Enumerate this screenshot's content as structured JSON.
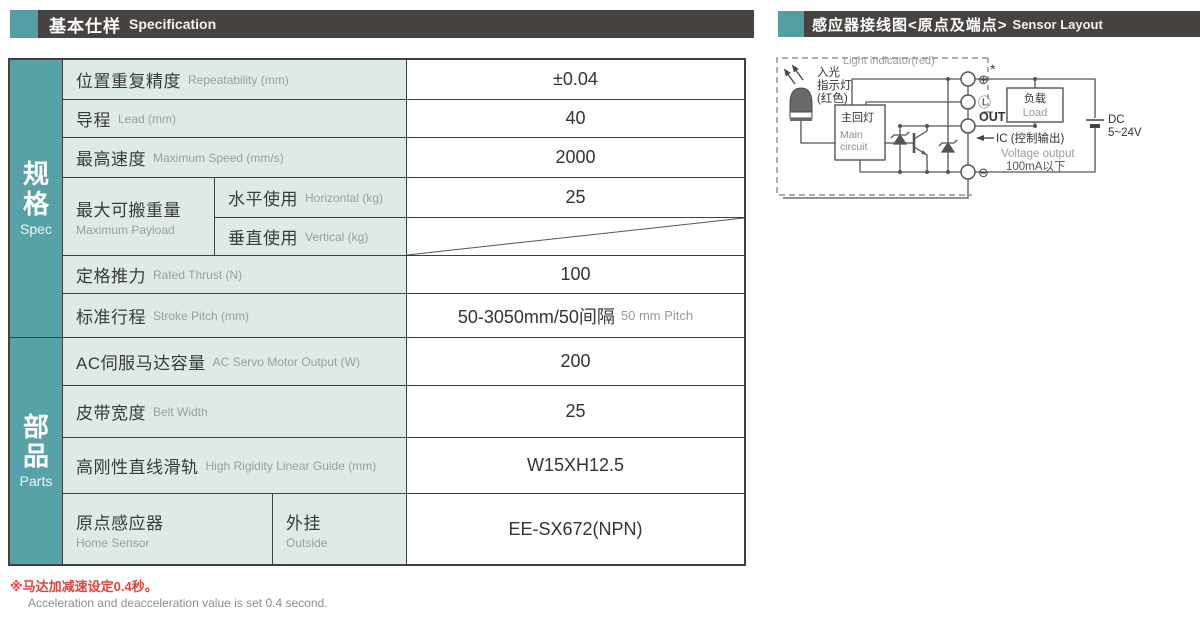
{
  "headers": {
    "left": {
      "zh": "基本仕样",
      "en": "Specification"
    },
    "right": {
      "zh": "感应器接线图<原点及端点>",
      "en": "Sensor Layout"
    }
  },
  "accent_color": "#539da3",
  "header_bar_color": "#474341",
  "table": {
    "sections": [
      {
        "zh": "规格",
        "en": "Spec"
      },
      {
        "zh": "部品",
        "en": "Parts"
      }
    ],
    "rows": {
      "repeatability": {
        "zh": "位置重复精度",
        "en": "Repeatability (mm)",
        "value": "±0.04"
      },
      "lead": {
        "zh": "导程",
        "en": "Lead (mm)",
        "value": "40"
      },
      "max_speed": {
        "zh": "最高速度",
        "en": "Maximum Speed (mm/s)",
        "value": "2000"
      },
      "payload": {
        "zh": "最大可搬重量",
        "en": "Maximum Payload",
        "horizontal": {
          "zh": "水平使用",
          "en": "Horizontal (kg)",
          "value": "25"
        },
        "vertical": {
          "zh": "垂直使用",
          "en": "Vertical (kg)",
          "value": ""
        }
      },
      "rated_thrust": {
        "zh": "定格推力",
        "en": "Rated Thrust (N)",
        "value": "100"
      },
      "stroke_pitch": {
        "zh": "标准行程",
        "en": "Stroke Pitch (mm)",
        "value": "50-3050mm/50间隔",
        "value_en": "50 mm Pitch"
      },
      "servo_output": {
        "zh": "AC伺服马达容量",
        "en": "AC Servo Motor Output (W)",
        "value": "200"
      },
      "belt_width": {
        "zh": "皮带宽度",
        "en": "Belt Width",
        "value": "25"
      },
      "linear_guide": {
        "zh": "高刚性直线滑轨",
        "en": "High Rigidity Linear Guide (mm)",
        "value": "W15XH12.5"
      },
      "home_sensor": {
        "zh": "原点感应器",
        "en": "Home Sensor",
        "sub_zh": "外挂",
        "sub_en": "Outside",
        "value": "EE-SX672(NPN)"
      }
    }
  },
  "notes": {
    "red": "※马达加减速设定0.4秒。",
    "gray": "Acceleration and deacceleration value is set 0.4 second."
  },
  "diagram": {
    "light_indicator_en": "Light indicator(red)",
    "incident_light_1": "入光",
    "incident_light_2": "指示灯",
    "incident_light_3": "(红色)",
    "main_circuit_zh": "主回灯",
    "main_circuit_en1": "Main",
    "main_circuit_en2": "circuit",
    "terminal_plus": "⊕",
    "terminal_star": "*",
    "terminal_l": "Ⓛ",
    "terminal_out": "OUT",
    "terminal_minus": "⊖",
    "ic_label": "IC (控制输出)",
    "voltage_output": "Voltage output",
    "current_limit": "100mA以下",
    "load_zh": "负载",
    "load_en": "Load",
    "dc_line1": "DC",
    "dc_line2": "5~24V"
  }
}
